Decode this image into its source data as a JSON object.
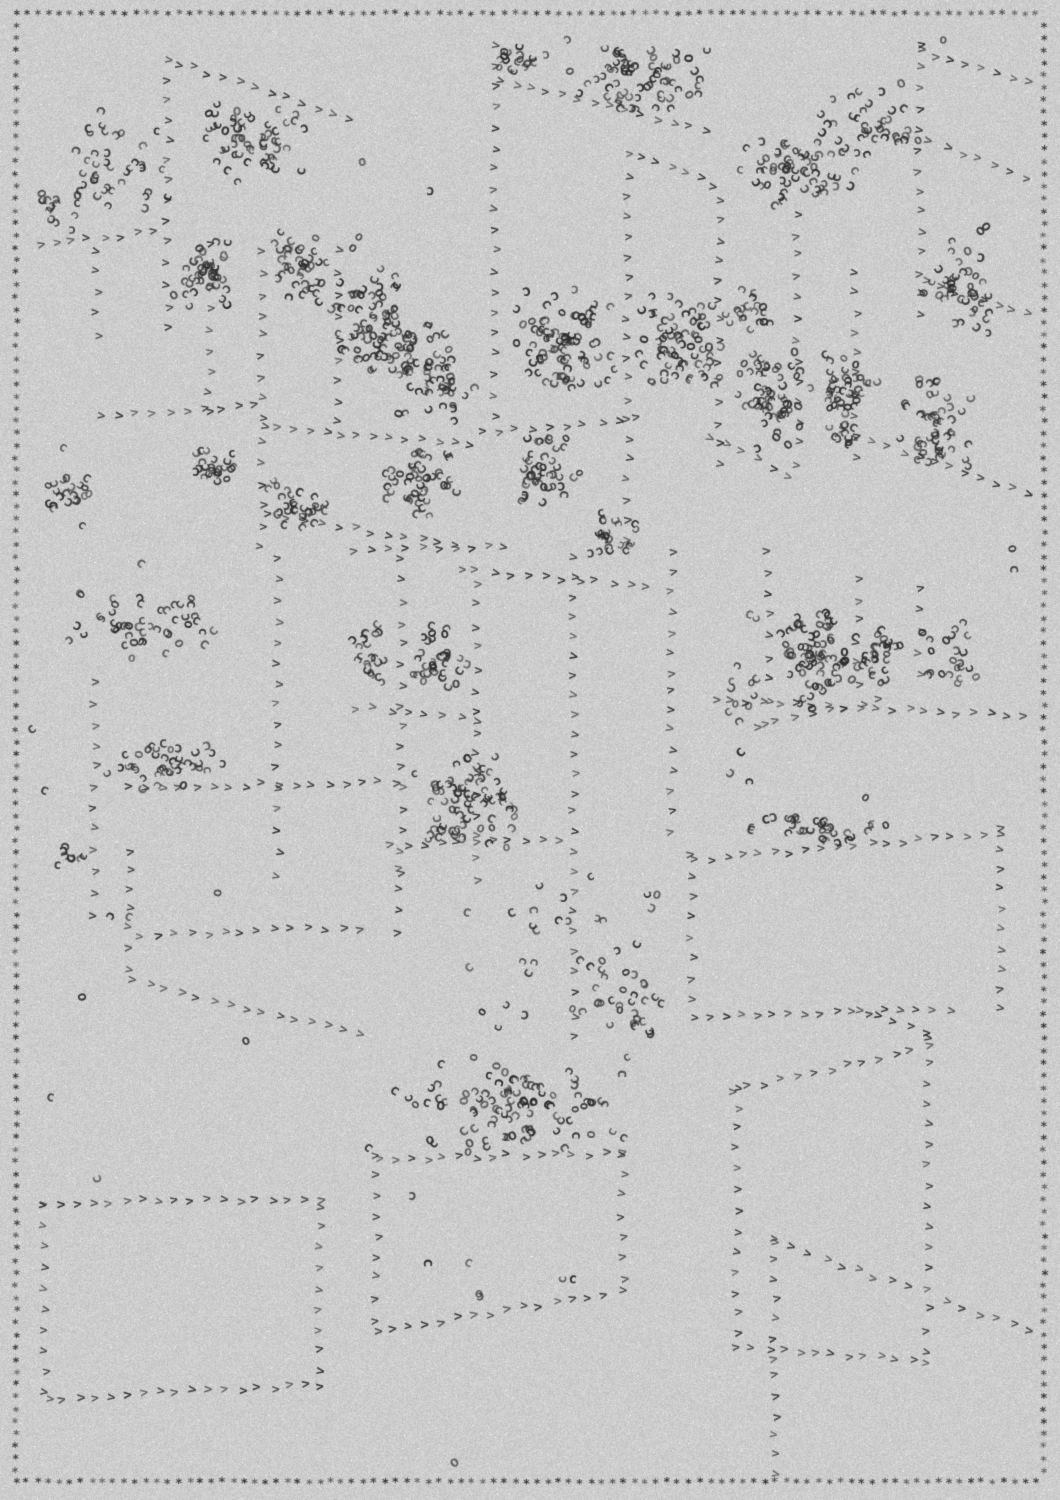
{
  "canvas": {
    "width": 1060,
    "height": 1500,
    "background": "#cdcdcd",
    "noise": {
      "amplitude": 13,
      "speckle_chance": 0.004,
      "speckle_boost": 34
    }
  },
  "ink": {
    "color_rgb": [
      46,
      46,
      46
    ],
    "alpha_base": 0.78,
    "alpha_jitter": 0.2
  },
  "glyphs": {
    "cluster_primary": "c",
    "cluster_secondary": "o",
    "secondary_ratio": 0.18,
    "line": ">",
    "border": "*"
  },
  "border": {
    "inset": 16,
    "step_x": 10.85,
    "step_y": 12.35
  },
  "style": {
    "cluster_glyph_size": 14,
    "line_glyph_size": 13,
    "border_glyph_size": 12,
    "column_step": 20.5,
    "row_step": 16.5
  },
  "seed": 1337,
  "columns": [
    [
      168,
      62,
      332
    ],
    [
      97,
      252,
      352
    ],
    [
      210,
      246,
      432
    ],
    [
      262,
      252,
      556
    ],
    [
      338,
      252,
      422
    ],
    [
      495,
      46,
      422
    ],
    [
      628,
      156,
      560
    ],
    [
      720,
      200,
      482
    ],
    [
      798,
      214,
      482
    ],
    [
      856,
      272,
      470
    ],
    [
      920,
      46,
      332
    ],
    [
      768,
      552,
      740
    ],
    [
      858,
      580,
      700
    ],
    [
      920,
      590,
      692
    ],
    [
      95,
      682,
      934
    ],
    [
      130,
      852,
      985
    ],
    [
      278,
      560,
      878
    ],
    [
      402,
      560,
      878
    ],
    [
      476,
      585,
      886
    ],
    [
      574,
      558,
      1046
    ],
    [
      672,
      553,
      845
    ],
    [
      398,
      868,
      942
    ],
    [
      692,
      856,
      1020
    ],
    [
      1000,
      830,
      1014
    ],
    [
      737,
      1090,
      1344
    ],
    [
      928,
      1040,
      1364
    ],
    [
      775,
      1240,
      1364
    ],
    [
      775,
      1376,
      1492
    ],
    [
      377,
      1156,
      1338
    ],
    [
      623,
      1156,
      1292
    ],
    [
      45,
      1206,
      1394
    ],
    [
      320,
      1208,
      1388
    ]
  ],
  "rows": [
    [
      178,
      64,
      348,
      118
    ],
    [
      500,
      80,
      705,
      132
    ],
    [
      920,
      52,
      1028,
      84
    ],
    [
      643,
      158,
      714,
      186
    ],
    [
      930,
      142,
      1028,
      178
    ],
    [
      925,
      283,
      1028,
      316
    ],
    [
      40,
      247,
      152,
      232
    ],
    [
      100,
      416,
      256,
      406
    ],
    [
      263,
      428,
      470,
      444
    ],
    [
      480,
      432,
      636,
      420
    ],
    [
      710,
      437,
      788,
      478
    ],
    [
      840,
      432,
      1030,
      495
    ],
    [
      270,
      514,
      456,
      547
    ],
    [
      355,
      553,
      504,
      546
    ],
    [
      460,
      570,
      647,
      587
    ],
    [
      358,
      708,
      477,
      721
    ],
    [
      760,
      727,
      880,
      700
    ],
    [
      715,
      700,
      1023,
      717
    ],
    [
      130,
      788,
      395,
      783
    ],
    [
      390,
      846,
      560,
      840
    ],
    [
      695,
      861,
      1000,
      833
    ],
    [
      693,
      1016,
      950,
      1011
    ],
    [
      860,
      1012,
      925,
      1032
    ],
    [
      140,
      936,
      360,
      928
    ],
    [
      133,
      982,
      360,
      1034
    ],
    [
      45,
      1203,
      322,
      1199
    ],
    [
      48,
      1399,
      322,
      1386
    ],
    [
      379,
      1160,
      621,
      1154
    ],
    [
      377,
      1333,
      622,
      1292
    ],
    [
      733,
      1092,
      928,
      1047
    ],
    [
      777,
      1244,
      908,
      1288
    ],
    [
      947,
      1302,
      1030,
      1332
    ],
    [
      737,
      1346,
      928,
      1362
    ]
  ],
  "clusters": [
    [
      115,
      165,
      55,
      60,
      38
    ],
    [
      250,
      140,
      62,
      48,
      55
    ],
    [
      55,
      212,
      27,
      26,
      16
    ],
    [
      205,
      272,
      36,
      42,
      42
    ],
    [
      300,
      266,
      32,
      46,
      40
    ],
    [
      372,
      330,
      48,
      62,
      75
    ],
    [
      432,
      372,
      46,
      52,
      62
    ],
    [
      562,
      342,
      55,
      57,
      85
    ],
    [
      678,
      342,
      50,
      55,
      68
    ],
    [
      745,
      310,
      28,
      30,
      20
    ],
    [
      770,
      402,
      40,
      56,
      55
    ],
    [
      845,
      400,
      40,
      50,
      50
    ],
    [
      930,
      420,
      46,
      50,
      48
    ],
    [
      958,
      280,
      45,
      55,
      42
    ],
    [
      790,
      170,
      72,
      40,
      58
    ],
    [
      865,
      125,
      55,
      42,
      38
    ],
    [
      640,
      80,
      78,
      36,
      66
    ],
    [
      523,
      58,
      35,
      18,
      18
    ],
    [
      72,
      497,
      28,
      22,
      20
    ],
    [
      215,
      470,
      30,
      28,
      24
    ],
    [
      300,
      505,
      35,
      30,
      30
    ],
    [
      420,
      480,
      46,
      40,
      45
    ],
    [
      545,
      468,
      40,
      40,
      42
    ],
    [
      610,
      540,
      30,
      28,
      22
    ],
    [
      135,
      625,
      85,
      42,
      48
    ],
    [
      165,
      765,
      75,
      28,
      40
    ],
    [
      70,
      855,
      45,
      12,
      8
    ],
    [
      440,
      665,
      32,
      48,
      35
    ],
    [
      370,
      660,
      25,
      40,
      22
    ],
    [
      480,
      800,
      72,
      50,
      62
    ],
    [
      818,
      658,
      42,
      58,
      72
    ],
    [
      880,
      660,
      28,
      35,
      28
    ],
    [
      952,
      648,
      36,
      38,
      22
    ],
    [
      740,
      700,
      28,
      90,
      14
    ],
    [
      820,
      828,
      78,
      17,
      32
    ],
    [
      448,
      832,
      30,
      10,
      10
    ],
    [
      570,
      965,
      110,
      105,
      42
    ],
    [
      635,
      1005,
      40,
      35,
      16
    ],
    [
      520,
      1105,
      122,
      50,
      95
    ]
  ],
  "singles": [
    [
      944,
      40
    ],
    [
      568,
      40
    ],
    [
      363,
      163
    ],
    [
      430,
      191
    ],
    [
      358,
      238
    ],
    [
      352,
      247
    ],
    [
      62,
      447
    ],
    [
      82,
      525
    ],
    [
      140,
      563
    ],
    [
      32,
      730
    ],
    [
      45,
      790
    ],
    [
      83,
      997
    ],
    [
      50,
      1097
    ],
    [
      97,
      1180
    ],
    [
      217,
      892
    ],
    [
      111,
      915
    ],
    [
      128,
      917
    ],
    [
      395,
      1090
    ],
    [
      368,
      1148
    ],
    [
      413,
      1195
    ],
    [
      427,
      1263
    ],
    [
      468,
      1262
    ],
    [
      480,
      1297
    ],
    [
      562,
      1280
    ],
    [
      573,
      1279
    ],
    [
      750,
      782
    ],
    [
      865,
      798
    ],
    [
      1012,
      548
    ],
    [
      1015,
      570
    ],
    [
      455,
      1462
    ],
    [
      478,
      1295
    ],
    [
      245,
      1041
    ]
  ]
}
